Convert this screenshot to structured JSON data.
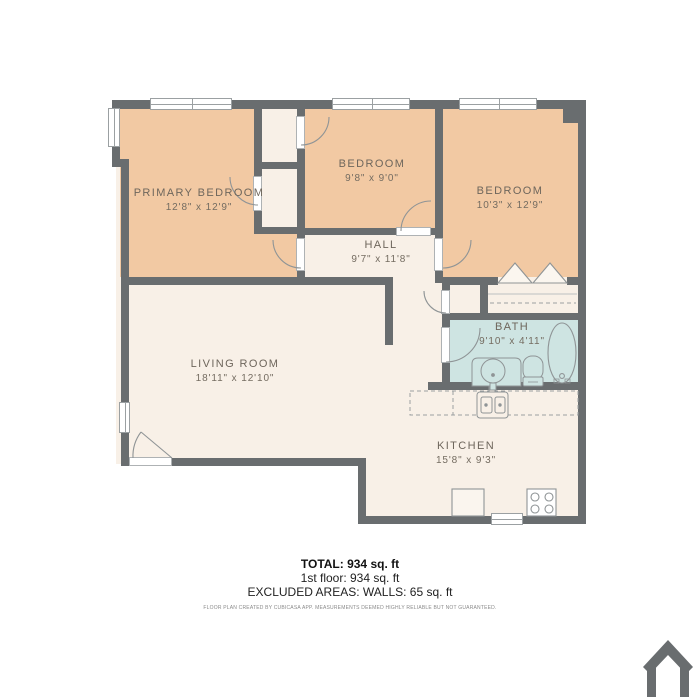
{
  "plan": {
    "rooms": [
      {
        "name": "PRIMARY BEDROOM",
        "dims": "12'8\" x 12'9\""
      },
      {
        "name": "BEDROOM",
        "dims": "9'8\" x 9'0\""
      },
      {
        "name": "BEDROOM",
        "dims": "10'3\" x 12'9\""
      },
      {
        "name": "HALL",
        "dims": "9'7\" x 11'8\""
      },
      {
        "name": "BATH",
        "dims": "9'10\" x 4'11\""
      },
      {
        "name": "LIVING ROOM",
        "dims": "18'11\" x 12'10\""
      },
      {
        "name": "KITCHEN",
        "dims": "15'8\" x 9'3\""
      }
    ],
    "fixtures": [
      "bathtub",
      "toilet",
      "vanity-sink",
      "kitchen-sink",
      "stove",
      "refrigerator",
      "wardrobe",
      "kitchen-counter",
      "bifold-closet-doors"
    ],
    "colors": {
      "wall": "#696d6f",
      "bedroom_floor": "#f2c9a3",
      "common_floor": "#f8f0e7",
      "bath_floor": "#cee4e2",
      "page_bg": "#ffffff"
    }
  },
  "summary": {
    "total": "TOTAL: 934 sq. ft",
    "floor1": "1st floor: 934 sq. ft",
    "excluded": "EXCLUDED AREAS: WALLS: 65 sq. ft",
    "disclaimer": "FLOOR PLAN CREATED BY CUBICASA APP. MEASUREMENTS DEEMED HIGHLY RELIABLE BUT NOT GUARANTEED."
  }
}
